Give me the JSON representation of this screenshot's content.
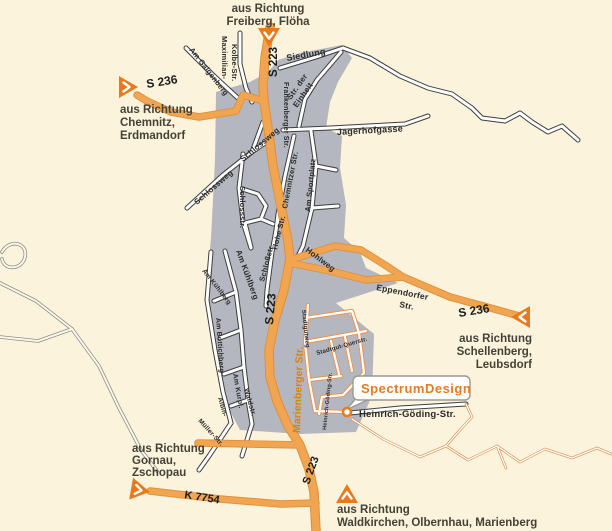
{
  "colors": {
    "background": "#FBF3DB",
    "urban_area": "#B4B7C0",
    "road_orange": "#F1A551",
    "accent_orange": "#E97A1C",
    "poi_text": "#E87B20",
    "street_label": "#2B2B2B",
    "direction_text": "#454136"
  },
  "roads": {
    "s223": "S 223",
    "s236": "S 236",
    "k7754": "K 7754"
  },
  "directions": {
    "north": {
      "line1": "aus Richtung",
      "line2": "Freiberg, Flöha"
    },
    "west": {
      "line1": "aus Richtung",
      "line2": "Chemnitz,",
      "line3": "Erdmandorf"
    },
    "east": {
      "line1": "aus Richtung",
      "line2": "Schellenberg,",
      "line3": "Leubsdorf"
    },
    "southwest": {
      "line1": "aus Richtung",
      "line2": "Gornau,",
      "line3": "Zschopau"
    },
    "south": {
      "line1": "aus Richtung",
      "line2": "Waldkirchen, Olbernhau, Marienberg"
    }
  },
  "streets": {
    "siedlung": "Siedlung",
    "str_der_einheit_1": "Str. der",
    "str_der_einheit_2": "Einheit",
    "jagerhofgasse": "Jagerhofgasse",
    "maximilian_1": "Maximilian-",
    "maximilian_2": "Kolbe-Str.",
    "am_galgenberg": "Am Galgenberg",
    "frankenberger": "Frankenberger Str.",
    "schlossweg": "Schlossweg",
    "schlossstr": "Schlossstr.",
    "schlossstr2": "Schloßstr.",
    "chemnitzer": "Chemnitzer Str.",
    "am_sportplatz": "Am Sportplatz",
    "hohe_str": "Hohe Str.",
    "hohlweg": "Hohlweg",
    "eppendorfer_1": "Eppendorfer",
    "eppendorfer_2": "Str.",
    "am_kuehlberg": "Am Kühlberg",
    "am_bottichberg": "Am Bottichberg",
    "am_kurpl": "Am Kurpl.",
    "waldstr": "Waldstr.",
    "albin": "Albin-",
    "mueller": "Müller-Str.",
    "marienberger": "Marienberger Str.",
    "stadtgutweg": "Stadtgutweg",
    "stadtgut_querstr": "Stadtgut-Querstr.",
    "heinrich_goeding": "Heinrich-Göding-Str."
  },
  "poi": {
    "name": "SpectrumDesign",
    "street_label": "Heinrich-Göding-Str."
  }
}
